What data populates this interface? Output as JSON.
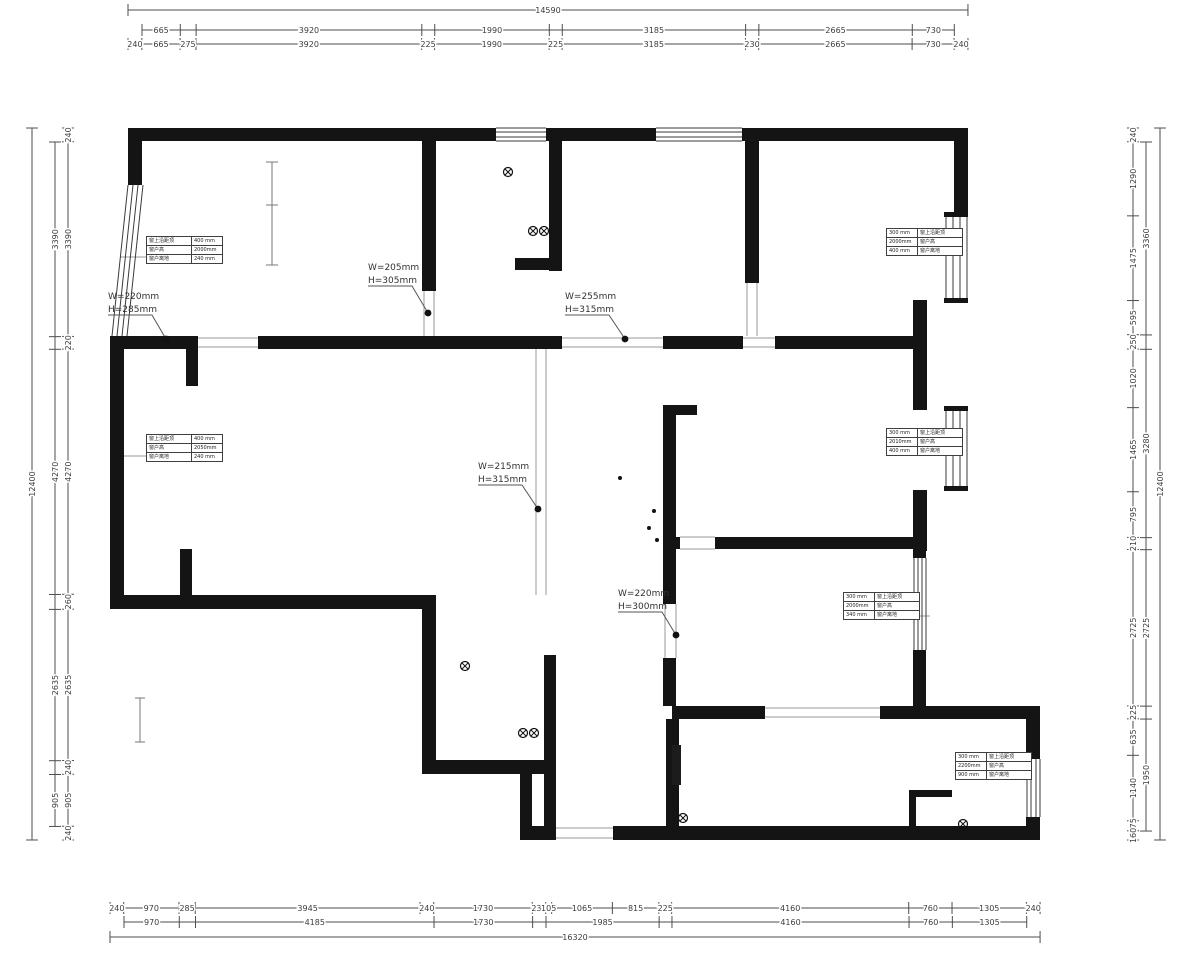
{
  "meta": {
    "drawing_type": "residential floor plan (CAD export)",
    "background": "#ffffff",
    "wall_color": "#141414",
    "dim_color": "#4d4d4d",
    "thin_color": "#9a9a9a",
    "window_line_color": "#3a3a3a"
  },
  "dim_chains": [
    {
      "id": "top-overall",
      "dir": "h",
      "line": 10,
      "start": 128,
      "scale": 0.05757,
      "vals": [
        14590
      ],
      "labels": [
        "14590"
      ]
    },
    {
      "id": "top-row2",
      "dir": "h",
      "line": 30,
      "start": 142,
      "scale": 0.05757,
      "vals": [
        665,
        275,
        3920,
        225,
        1990,
        225,
        3185,
        230,
        2665,
        730
      ],
      "labels": [
        "665",
        "",
        "3920",
        "",
        "1990",
        "",
        "3185",
        "",
        "2665",
        "730"
      ]
    },
    {
      "id": "top-row3",
      "dir": "h",
      "line": 44,
      "start": 128,
      "scale": 0.05757,
      "vals": [
        240,
        665,
        275,
        3920,
        225,
        1990,
        225,
        3185,
        230,
        2665,
        730,
        240
      ],
      "labels": [
        "240",
        "665",
        "275",
        "3920",
        "225",
        "1990",
        "225",
        "3185",
        "230",
        "2665",
        "730",
        "240"
      ]
    },
    {
      "id": "bottom-row1",
      "dir": "h",
      "line": 908,
      "start": 110,
      "scale": 0.05699,
      "vals": [
        240,
        970,
        285,
        3945,
        240,
        1730,
        235,
        105,
        1065,
        815,
        225,
        4160,
        760,
        1305,
        240
      ],
      "labels": [
        "240",
        "970",
        "285",
        "3945",
        "240",
        "1730",
        "235",
        "105",
        "1065",
        "815",
        "225",
        "4160",
        "760",
        "1305",
        "240"
      ]
    },
    {
      "id": "bottom-row2",
      "dir": "h",
      "line": 922,
      "start": 124,
      "scale": 0.05699,
      "vals": [
        970,
        285,
        4185,
        1730,
        235,
        1985,
        225,
        4160,
        760,
        1305
      ],
      "labels": [
        "970",
        "",
        "4185",
        "1730",
        "",
        "1985",
        "",
        "4160",
        "760",
        "1305"
      ]
    },
    {
      "id": "bottom-row3",
      "dir": "h",
      "line": 937,
      "start": 110,
      "scale": 0.05699,
      "vals": [
        16320
      ],
      "labels": [
        "16320"
      ]
    },
    {
      "id": "left-inner",
      "dir": "v",
      "line": 68,
      "start": 128,
      "scale": 0.05742,
      "vals": [
        240,
        3390,
        220,
        4270,
        260,
        2635,
        240,
        905,
        240
      ],
      "labels": [
        "240",
        "3390",
        "220",
        "4270",
        "260",
        "2635",
        "240",
        "905",
        "240"
      ]
    },
    {
      "id": "left-mid",
      "dir": "v",
      "line": 55,
      "start": 142,
      "scale": 0.05742,
      "vals": [
        3390,
        220,
        4270,
        260,
        2635,
        240,
        905
      ],
      "labels": [
        "3390",
        "",
        "4270",
        "",
        "2635",
        "",
        "905"
      ]
    },
    {
      "id": "left-outer",
      "dir": "v",
      "line": 32,
      "start": 128,
      "scale": 0.05742,
      "vals": [
        12400
      ],
      "labels": [
        "12400"
      ]
    },
    {
      "id": "right-inner",
      "dir": "v",
      "line": 1133,
      "start": 128,
      "scale": 0.05742,
      "vals": [
        240,
        1290,
        1475,
        595,
        250,
        1020,
        1465,
        795,
        210,
        2725,
        225,
        635,
        1140,
        175,
        160
      ],
      "labels": [
        "240",
        "1290",
        "1475",
        "595",
        "250",
        "1020",
        "1465",
        "795",
        "210",
        "2725",
        "225",
        "635",
        "1140",
        "175",
        "160"
      ]
    },
    {
      "id": "right-mid",
      "dir": "v",
      "line": 1146,
      "start": 142,
      "scale": 0.05742,
      "vals": [
        3360,
        250,
        3280,
        210,
        2725,
        225,
        1950
      ],
      "labels": [
        "3360",
        "",
        "3280",
        "",
        "2725",
        "",
        "1950"
      ]
    },
    {
      "id": "right-outer",
      "dir": "v",
      "line": 1160,
      "start": 128,
      "scale": 0.05742,
      "vals": [
        12400
      ],
      "labels": [
        "12400"
      ]
    }
  ],
  "door_annotations": [
    {
      "w": "W=220mm",
      "h": "H=285mm",
      "tx": 108,
      "ty": 291,
      "dx": 166,
      "dy": 339
    },
    {
      "w": "W=205mm",
      "h": "H=305mm",
      "tx": 368,
      "ty": 262,
      "dx": 428,
      "dy": 313
    },
    {
      "w": "W=255mm",
      "h": "H=315mm",
      "tx": 565,
      "ty": 291,
      "dx": 625,
      "dy": 339
    },
    {
      "w": "W=215mm",
      "h": "H=315mm",
      "tx": 478,
      "ty": 461,
      "dx": 538,
      "dy": 509
    },
    {
      "w": "W=220mm",
      "h": "H=300mm",
      "tx": 618,
      "ty": 588,
      "dx": 676,
      "dy": 635
    }
  ],
  "window_tables": [
    {
      "x": 146,
      "y": 236,
      "side": "left",
      "rows": [
        [
          "窗上沿距顶",
          "400 mm"
        ],
        [
          "窗户高",
          "2000mm"
        ],
        [
          "窗户离地",
          "240 mm"
        ]
      ]
    },
    {
      "x": 886,
      "y": 228,
      "side": "right",
      "rows": [
        [
          "300 mm",
          "窗上沿距顶"
        ],
        [
          "2000mm",
          "窗户高"
        ],
        [
          "400 mm",
          "窗户离地"
        ]
      ]
    },
    {
      "x": 146,
      "y": 434,
      "side": "left",
      "rows": [
        [
          "窗上沿距顶",
          "400 mm"
        ],
        [
          "窗户高",
          "2050mm"
        ],
        [
          "窗户离地",
          "240 mm"
        ]
      ]
    },
    {
      "x": 886,
      "y": 428,
      "side": "right",
      "rows": [
        [
          "300 mm",
          "窗上沿距顶"
        ],
        [
          "2010mm",
          "窗户高"
        ],
        [
          "400 mm",
          "窗户离地"
        ]
      ]
    },
    {
      "x": 843,
      "y": 592,
      "side": "right",
      "rows": [
        [
          "300 mm",
          "窗上沿距顶"
        ],
        [
          "2000mm",
          "窗户高"
        ],
        [
          "340 mm",
          "窗户离地"
        ]
      ]
    },
    {
      "x": 955,
      "y": 752,
      "side": "right",
      "rows": [
        [
          "300 mm",
          "窗上沿距顶"
        ],
        [
          "2200mm",
          "窗户高"
        ],
        [
          "900 mm",
          "窗户离地"
        ]
      ]
    }
  ],
  "symbols": {
    "drains": [
      [
        508,
        172
      ],
      [
        533,
        231
      ],
      [
        544,
        231
      ],
      [
        465,
        666
      ],
      [
        523,
        733
      ],
      [
        534,
        733
      ],
      [
        683,
        818
      ],
      [
        963,
        824
      ]
    ],
    "dots": [
      [
        620,
        478
      ],
      [
        654,
        511
      ],
      [
        649,
        528
      ],
      [
        657,
        540
      ]
    ]
  }
}
